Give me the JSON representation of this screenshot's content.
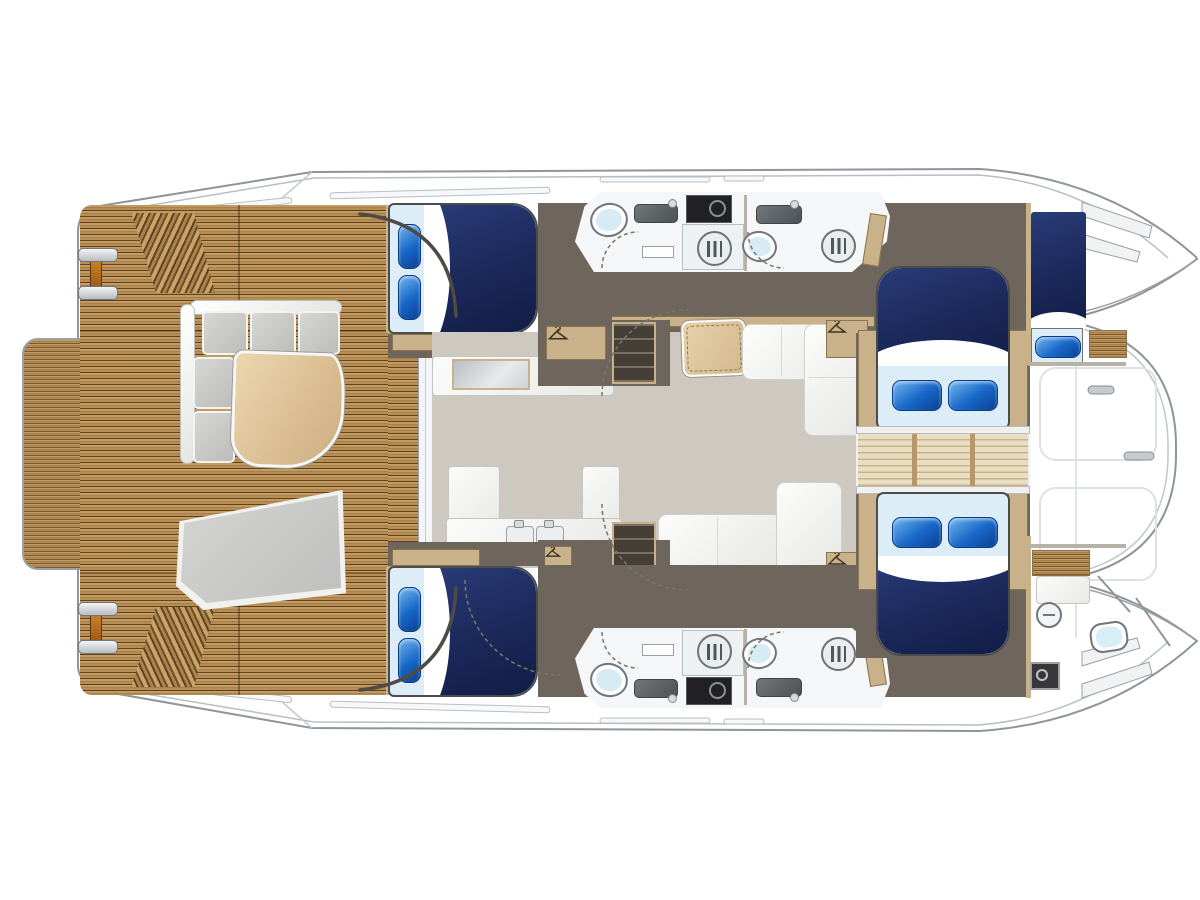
{
  "diagram": {
    "type": "yacht-deck-plan",
    "vessel": "power-catamaran-layout",
    "orientation": {
      "bow": "right",
      "stern": "left"
    },
    "areas": [
      {
        "id": "swim-platform",
        "label": "teak swim platform"
      },
      {
        "id": "aft-deck",
        "label": "aft cockpit with L-sofa, table and lounge seat"
      },
      {
        "id": "salon",
        "label": "salon with galley, dinette and sofa"
      },
      {
        "id": "port-aft-cabin",
        "label": "double cabin with bed"
      },
      {
        "id": "starboard-aft-cabin",
        "label": "double cabin with bed"
      },
      {
        "id": "port-heads",
        "label": "two bathrooms with showers and washer"
      },
      {
        "id": "starboard-heads",
        "label": "two bathrooms with showers and washer"
      },
      {
        "id": "port-forward-cabin",
        "label": "forward double cabin"
      },
      {
        "id": "starboard-forward-cabin",
        "label": "forward double cabin"
      },
      {
        "id": "bow-walkway",
        "label": "slatted walkway between forward cabins"
      },
      {
        "id": "skipper-cabin",
        "label": "bow single berth"
      },
      {
        "id": "crew-head",
        "label": "bow bathroom"
      },
      {
        "id": "foredeck",
        "label": "foredeck with hatches and anchor lockers"
      }
    ],
    "feature_counts": {
      "double_beds": 4,
      "single_beds": 1,
      "toilets": 5,
      "showers": 4,
      "washing_machines": 2,
      "wardrobes": 4,
      "cleats": 2
    },
    "icons": [
      "hanger-icon",
      "shower-drain-icon",
      "toilet-icon",
      "sink-icon",
      "washing-machine-icon",
      "cleat-icon",
      "tv-icon",
      "deck-hatch-icon"
    ]
  },
  "palette": {
    "teak_light": "#c39a60",
    "teak_dark": "#8a6637",
    "trim": "#c9b189",
    "taupe": "#6e665c",
    "salon_floor": "#cdc9c1",
    "bath": "#f4f6f7",
    "navy": "#1d2b5f",
    "sheet": "#dcedf8",
    "pillow_blue": "#1767c8",
    "hull_line": "#8e959b"
  }
}
